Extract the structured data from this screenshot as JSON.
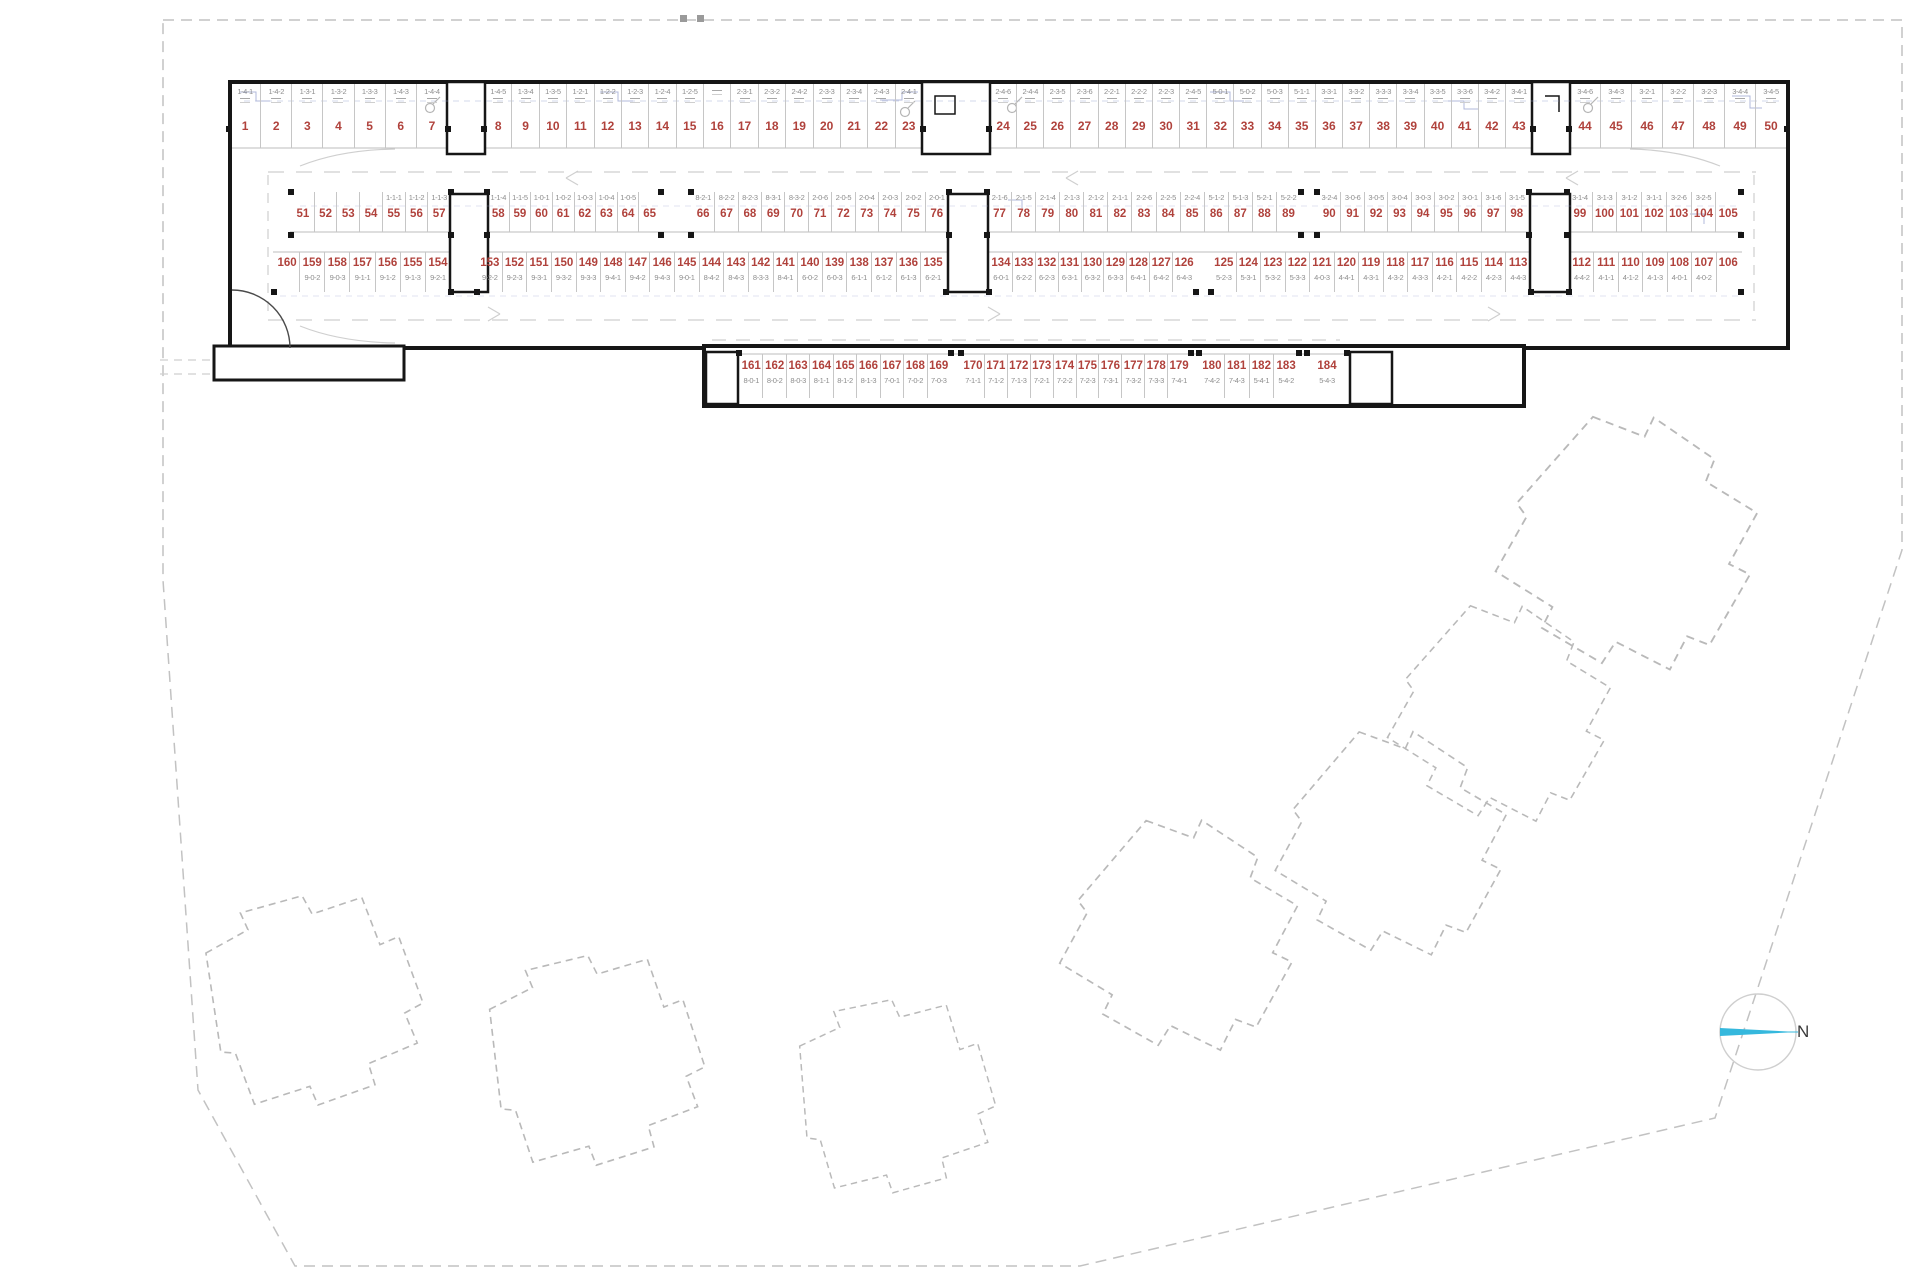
{
  "compass": {
    "label": "N",
    "needle_color": "#35b8dd"
  },
  "colors": {
    "stall_number": "#b0423c",
    "unit_code": "#8e8e8e",
    "wall": "#161616",
    "site_boundary": "#c2c2c2",
    "future_building_outline": "#b9b9b9",
    "detail_line_blue": "#96a0cf"
  },
  "parking": {
    "rows": [
      {
        "id": "top-row",
        "code_position": "above",
        "groups": [
          {
            "stalls": [
              [
                "1",
                "1-4-1"
              ],
              [
                "2",
                "1-4-2"
              ],
              [
                "3",
                "1-3-1"
              ],
              [
                "4",
                "1-3-2"
              ],
              [
                "5",
                "1-3-3"
              ],
              [
                "6",
                "1-4-3"
              ],
              [
                "7",
                "1-4-4"
              ]
            ]
          },
          {
            "stalls": [
              [
                "8",
                "1-4-5"
              ],
              [
                "9",
                "1-3-4"
              ],
              [
                "10",
                "1-3-5"
              ],
              [
                "11",
                "1-2-1"
              ],
              [
                "12",
                "1-2-2"
              ],
              [
                "13",
                "1-2-3"
              ],
              [
                "14",
                "1-2-4"
              ],
              [
                "15",
                "1-2-5"
              ],
              [
                "16",
                ""
              ],
              [
                "17",
                "2-3-1"
              ],
              [
                "18",
                "2-3-2"
              ],
              [
                "19",
                "2-4-2"
              ],
              [
                "20",
                "2-3-3"
              ],
              [
                "21",
                "2-3-4"
              ],
              [
                "22",
                "2-4-3"
              ],
              [
                "23",
                "2-4-1"
              ]
            ]
          },
          {
            "stalls": [
              [
                "24",
                "2-4-6"
              ],
              [
                "25",
                "2-4-4"
              ],
              [
                "26",
                "2-3-5"
              ],
              [
                "27",
                "2-3-6"
              ],
              [
                "28",
                "2-2-1"
              ],
              [
                "29",
                "2-2-2"
              ],
              [
                "30",
                "2-2-3"
              ],
              [
                "31",
                "2-4-5"
              ],
              [
                "32",
                "5-0-1"
              ],
              [
                "33",
                "5-0-2"
              ],
              [
                "34",
                "5-0-3"
              ],
              [
                "35",
                "5-1-1"
              ],
              [
                "36",
                "3-3-1"
              ],
              [
                "37",
                "3-3-2"
              ],
              [
                "38",
                "3-3-3"
              ],
              [
                "39",
                "3-3-4"
              ],
              [
                "40",
                "3-3-5"
              ],
              [
                "41",
                "3-3-6"
              ],
              [
                "42",
                "3-4-2"
              ],
              [
                "43",
                "3-4-1"
              ]
            ]
          },
          {
            "stalls": [
              [
                "44",
                "3-4-6"
              ],
              [
                "45",
                "3-4-3"
              ],
              [
                "46",
                "3-2-1"
              ],
              [
                "47",
                "3-2-2"
              ],
              [
                "48",
                "3-2-3"
              ],
              [
                "49",
                "3-4-4"
              ],
              [
                "50",
                "3-4-5"
              ]
            ]
          }
        ]
      },
      {
        "id": "middle-upper-row",
        "code_position": "above",
        "groups": [
          {
            "stalls": [
              [
                "51",
                ""
              ],
              [
                "52",
                ""
              ],
              [
                "53",
                ""
              ],
              [
                "54",
                ""
              ],
              [
                "55",
                "1-1-1"
              ],
              [
                "56",
                "1-1-2"
              ],
              [
                "57",
                "1-1-3"
              ]
            ]
          },
          {
            "stalls": [
              [
                "58",
                "1-1-4"
              ],
              [
                "59",
                "1-1-5"
              ],
              [
                "60",
                "1-0-1"
              ],
              [
                "61",
                "1-0-2"
              ],
              [
                "62",
                "1-0-3"
              ],
              [
                "63",
                "1-0-4"
              ],
              [
                "64",
                "1-0-5"
              ],
              [
                "65",
                ""
              ]
            ]
          },
          {
            "stalls": [
              [
                "66",
                "8-2-1"
              ],
              [
                "67",
                "8-2-2"
              ],
              [
                "68",
                "8-2-3"
              ],
              [
                "69",
                "8-3-1"
              ],
              [
                "70",
                "8-3-2"
              ],
              [
                "71",
                "2-0-6"
              ],
              [
                "72",
                "2-0-5"
              ],
              [
                "73",
                "2-0-4"
              ],
              [
                "74",
                "2-0-3"
              ],
              [
                "75",
                "2-0-2"
              ],
              [
                "76",
                "2-0-1"
              ]
            ]
          },
          {
            "stalls": [
              [
                "77",
                "2-1-6"
              ],
              [
                "78",
                "2-1-5"
              ],
              [
                "79",
                "2-1-4"
              ],
              [
                "80",
                "2-1-3"
              ],
              [
                "81",
                "2-1-2"
              ],
              [
                "82",
                "2-1-1"
              ],
              [
                "83",
                "2-2-6"
              ],
              [
                "84",
                "2-2-5"
              ],
              [
                "85",
                "2-2-4"
              ],
              [
                "86",
                "5-1-2"
              ],
              [
                "87",
                "5-1-3"
              ],
              [
                "88",
                "5-2-1"
              ],
              [
                "89",
                "5-2-2"
              ]
            ]
          },
          {
            "stalls": [
              [
                "90",
                "3-2-4"
              ],
              [
                "91",
                "3-0-6"
              ],
              [
                "92",
                "3-0-5"
              ],
              [
                "93",
                "3-0-4"
              ],
              [
                "94",
                "3-0-3"
              ],
              [
                "95",
                "3-0-2"
              ],
              [
                "96",
                "3-0-1"
              ],
              [
                "97",
                "3-1-6"
              ],
              [
                "98",
                "3-1-5"
              ]
            ]
          },
          {
            "stalls": [
              [
                "99",
                "3-1-4"
              ],
              [
                "100",
                "3-1-3"
              ],
              [
                "101",
                "3-1-2"
              ],
              [
                "102",
                "3-1-1"
              ],
              [
                "103",
                "3-2-6"
              ],
              [
                "104",
                "3-2-5"
              ],
              [
                "105",
                ""
              ]
            ]
          }
        ]
      },
      {
        "id": "middle-lower-row",
        "code_position": "below",
        "groups": [
          {
            "stalls": [
              [
                "160",
                ""
              ],
              [
                "159",
                "9-0-2"
              ],
              [
                "158",
                "9-0-3"
              ],
              [
                "157",
                "9-1-1"
              ],
              [
                "156",
                "9-1-2"
              ],
              [
                "155",
                "9-1-3"
              ],
              [
                "154",
                "9-2-1"
              ]
            ]
          },
          {
            "stalls": [
              [
                "153",
                "9-2-2"
              ],
              [
                "152",
                "9-2-3"
              ],
              [
                "151",
                "9-3-1"
              ],
              [
                "150",
                "9-3-2"
              ],
              [
                "149",
                "9-3-3"
              ],
              [
                "148",
                "9-4-1"
              ],
              [
                "147",
                "9-4-2"
              ],
              [
                "146",
                "9-4-3"
              ],
              [
                "145",
                "9-0-1"
              ],
              [
                "144",
                "8-4-2"
              ],
              [
                "143",
                "8-4-3"
              ],
              [
                "142",
                "8-3-3"
              ],
              [
                "141",
                "8-4-1"
              ],
              [
                "140",
                "6-0-2"
              ],
              [
                "139",
                "6-0-3"
              ],
              [
                "138",
                "6-1-1"
              ],
              [
                "137",
                "6-1-2"
              ],
              [
                "136",
                "6-1-3"
              ],
              [
                "135",
                "6-2-1"
              ]
            ]
          },
          {
            "stalls": [
              [
                "134",
                "6-0-1"
              ],
              [
                "133",
                "6-2-2"
              ],
              [
                "132",
                "6-2-3"
              ],
              [
                "131",
                "6-3-1"
              ],
              [
                "130",
                "6-3-2"
              ],
              [
                "129",
                "6-3-3"
              ],
              [
                "128",
                "6-4-1"
              ],
              [
                "127",
                "6-4-2"
              ],
              [
                "126",
                "6-4-3"
              ]
            ]
          },
          {
            "stalls": [
              [
                "125",
                "5-2-3"
              ],
              [
                "124",
                "5-3-1"
              ],
              [
                "123",
                "5-3-2"
              ],
              [
                "122",
                "5-3-3"
              ],
              [
                "121",
                "4-0-3"
              ],
              [
                "120",
                "4-4-1"
              ],
              [
                "119",
                "4-3-1"
              ],
              [
                "118",
                "4-3-2"
              ],
              [
                "117",
                "4-3-3"
              ],
              [
                "116",
                "4-2-1"
              ],
              [
                "115",
                "4-2-2"
              ],
              [
                "114",
                "4-2-3"
              ],
              [
                "113",
                "4-4-3"
              ]
            ]
          },
          {
            "stalls": [
              [
                "112",
                "4-4-2"
              ],
              [
                "111",
                "4-1-1"
              ],
              [
                "110",
                "4-1-2"
              ],
              [
                "109",
                "4-1-3"
              ],
              [
                "108",
                "4-0-1"
              ],
              [
                "107",
                "4-0-2"
              ],
              [
                "106",
                ""
              ]
            ]
          }
        ]
      },
      {
        "id": "bottom-row",
        "code_position": "below",
        "groups": [
          {
            "stalls": [
              [
                "161",
                "8-0-1"
              ],
              [
                "162",
                "8-0-2"
              ],
              [
                "163",
                "8-0-3"
              ],
              [
                "164",
                "8-1-1"
              ],
              [
                "165",
                "8-1-2"
              ],
              [
                "166",
                "8-1-3"
              ],
              [
                "167",
                "7-0-1"
              ],
              [
                "168",
                "7-0-2"
              ],
              [
                "169",
                "7-0-3"
              ]
            ]
          },
          {
            "stalls": [
              [
                "170",
                "7-1-1"
              ],
              [
                "171",
                "7-1-2"
              ],
              [
                "172",
                "7-1-3"
              ],
              [
                "173",
                "7-2-1"
              ],
              [
                "174",
                "7-2-2"
              ],
              [
                "175",
                "7-2-3"
              ],
              [
                "176",
                "7-3-1"
              ],
              [
                "177",
                "7-3-2"
              ],
              [
                "178",
                "7-3-3"
              ],
              [
                "179",
                "7-4-1"
              ]
            ]
          },
          {
            "stalls": [
              [
                "180",
                "7-4-2"
              ],
              [
                "181",
                "7-4-3"
              ],
              [
                "182",
                "5-4-1"
              ],
              [
                "183",
                "5-4-2"
              ]
            ]
          },
          {
            "stalls": [
              [
                "184",
                "5-4-3"
              ]
            ]
          }
        ]
      }
    ]
  }
}
